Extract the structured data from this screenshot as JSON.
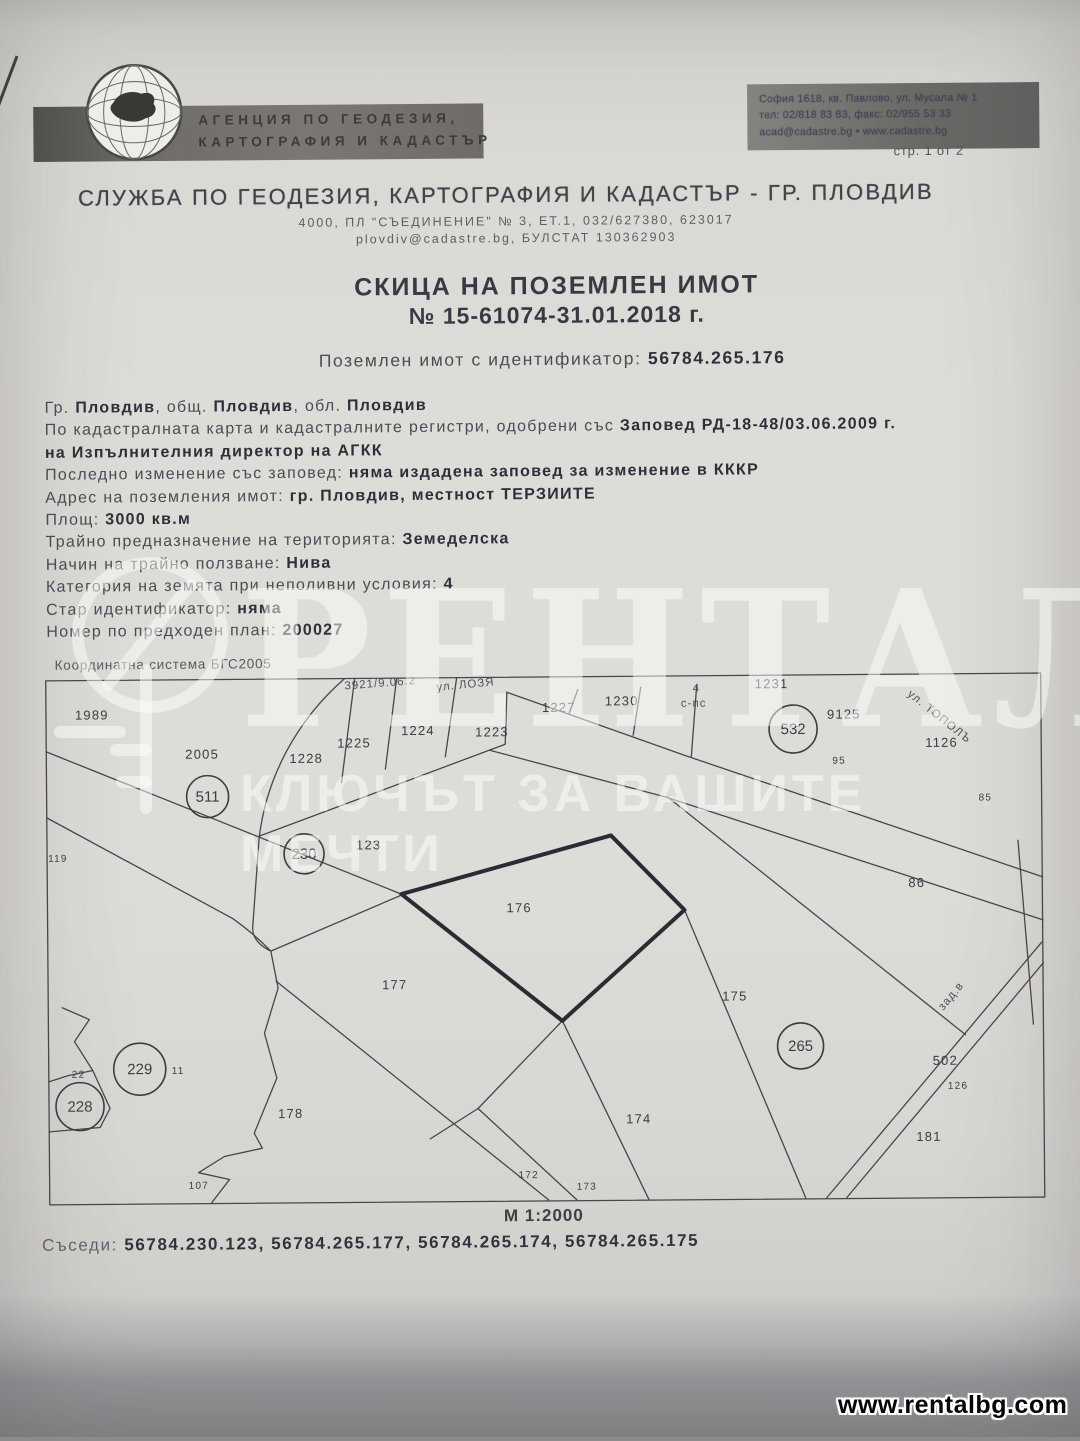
{
  "colors": {
    "paper": "#dedcd8",
    "banner": "#6f6c67",
    "ink": "#3c3c44",
    "watermark": "rgba(253,253,251,0.5)"
  },
  "header": {
    "agency_line1": "АГЕНЦИЯ ПО ГЕОДЕЗИЯ,",
    "agency_line2": "КАРТОГРАФИЯ И КАДАСТЪР",
    "address_line1": "София 1618, кв. Павлово, ул. Мусала № 1",
    "address_line2": "тел: 02/818 83 83, факс: 02/955 53 33",
    "address_line3": "acad@cadastre.bg • www.cadastre.bg",
    "page_label": "стр. 1 от 2"
  },
  "office": {
    "title": "СЛУЖБА ПО ГЕОДЕЗИЯ, КАРТОГРАФИЯ И КАДАСТЪР - ГР. ПЛОВДИВ",
    "address_line": "4000, ПЛ \"СЪЕДИНЕНИЕ\" № 3, ЕТ.1, 032/627380, 623017",
    "contact_line": "plovdiv@cadastre.bg, БУЛСТАТ 130362903"
  },
  "document": {
    "title": "СКИЦА НА ПОЗЕМЛЕН ИМОТ",
    "number": "№ 15-61074-31.01.2018 г.",
    "identifier_label": "Поземлен имот с  идентификатор:",
    "identifier": "56784.265.176"
  },
  "property_lines": {
    "l1": {
      "p1": "Гр. ",
      "b1": "Пловдив",
      "p2": ", общ. ",
      "b2": "Пловдив",
      "p3": ", обл. ",
      "b3": "Пловдив"
    },
    "l2": {
      "p": "По кадастралната карта и кадастралните регистри, одобрени със ",
      "b": "Заповед РД-18-48/03.06.2009 г."
    },
    "l3": {
      "b": "на Изпълнителния директор на АГКК"
    },
    "l4": {
      "p": "Последно изменение със заповед: ",
      "b": "няма издадена заповед за изменение в КККР"
    },
    "l5": {
      "p": "Адрес на поземления имот: ",
      "b": "гр. Пловдив, местност ТЕРЗИИТЕ"
    },
    "l6": {
      "p": "Площ: ",
      "b": "3000 кв.м"
    },
    "l7": {
      "p": "Трайно предназначение на територията: ",
      "b": "Земеделска"
    },
    "l8": {
      "p": "Начин на трайно ползване: ",
      "b": "Нива"
    },
    "l9": {
      "p": "Категория на земята при неполивни условия: ",
      "b": "4"
    },
    "l10": {
      "p": "Стар идентификатор: ",
      "b": "няма"
    },
    "l11": {
      "p": "Номер по предходен план: ",
      "b": "200027"
    }
  },
  "map": {
    "coordinate_system": "Координатна система БГС2005",
    "scale": "М 1:2000",
    "neighbors_label": "Съседи:",
    "neighbors": "56784.230.123, 56784.265.177, 56784.265.174, 56784.265.175",
    "circles": [
      {
        "n": "511",
        "x": 162,
        "y": 118,
        "r": 21
      },
      {
        "n": "230",
        "x": 258,
        "y": 176,
        "r": 20
      },
      {
        "n": "532",
        "x": 748,
        "y": 55,
        "r": 24
      },
      {
        "n": "229",
        "x": 92,
        "y": 390,
        "r": 26
      },
      {
        "n": "228",
        "x": 32,
        "y": 427,
        "r": 24
      },
      {
        "n": "265",
        "x": 753,
        "y": 372,
        "r": 23
      }
    ],
    "labels": [
      {
        "n": "1989",
        "x": 30,
        "y": 40
      },
      {
        "n": "2005",
        "x": 140,
        "y": 80
      },
      {
        "n": "119",
        "x": 2,
        "y": 182,
        "s": 1
      },
      {
        "n": "1228",
        "x": 244,
        "y": 85
      },
      {
        "n": "1225",
        "x": 292,
        "y": 70
      },
      {
        "n": "1224",
        "x": 356,
        "y": 58
      },
      {
        "n": "1223",
        "x": 430,
        "y": 60
      },
      {
        "n": "1227",
        "x": 497,
        "y": 36
      },
      {
        "n": "1230",
        "x": 560,
        "y": 30
      },
      {
        "n": "1231",
        "x": 710,
        "y": 14
      },
      {
        "n": "9125",
        "x": 782,
        "y": 45
      },
      {
        "n": "1126",
        "x": 880,
        "y": 74
      },
      {
        "n": "95",
        "x": 787,
        "y": 90,
        "s": 1
      },
      {
        "n": "85",
        "x": 933,
        "y": 128,
        "s": 1
      },
      {
        "n": "123",
        "x": 310,
        "y": 172
      },
      {
        "n": "176",
        "x": 460,
        "y": 236
      },
      {
        "n": "177",
        "x": 335,
        "y": 312
      },
      {
        "n": "178",
        "x": 230,
        "y": 440
      },
      {
        "n": "175",
        "x": 675,
        "y": 326
      },
      {
        "n": "86",
        "x": 862,
        "y": 214
      },
      {
        "n": "174",
        "x": 578,
        "y": 448
      },
      {
        "n": "172",
        "x": 470,
        "y": 502,
        "s": 1
      },
      {
        "n": "173",
        "x": 528,
        "y": 514,
        "s": 1
      },
      {
        "n": "181",
        "x": 868,
        "y": 468
      },
      {
        "n": "502",
        "x": 885,
        "y": 392
      },
      {
        "n": "126",
        "x": 900,
        "y": 416,
        "s": 1
      },
      {
        "n": "22",
        "x": 24,
        "y": 398,
        "s": 1
      },
      {
        "n": "11",
        "x": 124,
        "y": 395,
        "s": 1
      },
      {
        "n": "107",
        "x": 140,
        "y": 510,
        "s": 1
      }
    ],
    "street_labels": [
      {
        "t": "3921/9.06.2",
        "x": 300,
        "y": 12,
        "rot": -4
      },
      {
        "t": "ул. ЛОЗЯ",
        "x": 392,
        "y": 14,
        "rot": -5
      },
      {
        "t": "с-пс",
        "x": 636,
        "y": 32,
        "rot": 0
      },
      {
        "t": "4",
        "x": 648,
        "y": 17,
        "rot": 0
      },
      {
        "t": "ул. ТОПОЛЪ",
        "x": 862,
        "y": 22,
        "rot": 39
      },
      {
        "t": "зад.в",
        "x": 896,
        "y": 338,
        "rot": -50
      }
    ]
  },
  "watermark": {
    "brand": "РЕНТАЛ",
    "slogan": "КЛЮЧЪТ ЗА ВАШИТЕ МЕЧТИ",
    "site": "www.rentalbg.com"
  }
}
